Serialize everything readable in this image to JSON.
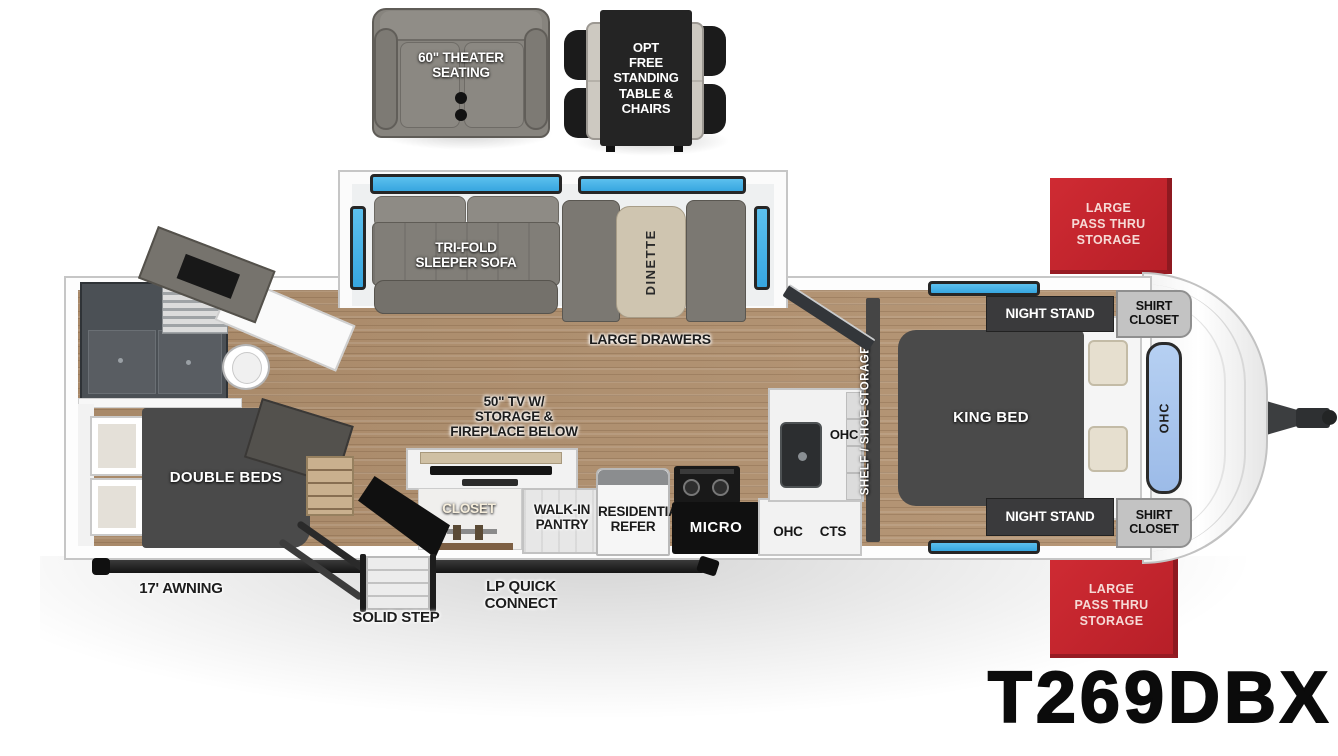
{
  "model_label": "T269DBX",
  "options": {
    "theater_seating": "60\" THEATER\nSEATING",
    "free_standing_table": "OPT\nFREE\nSTANDING\nTABLE &\nCHAIRS"
  },
  "living_area": {
    "sofa": "TRI-FOLD\nSLEEPER SOFA",
    "dinette": "DINETTE",
    "large_drawers": "LARGE DRAWERS",
    "tv_fireplace": "50\" TV W/\nSTORAGE &\nFIREPLACE BELOW",
    "closet": "CLOSET"
  },
  "kitchen": {
    "pantry": "WALK-IN\nPANTRY",
    "refer": "RESIDENTIAL\nREFER",
    "micro": "MICRO",
    "ohc_upper": "OHC",
    "ohc_lower": "OHC",
    "cts": "CTS"
  },
  "bedroom": {
    "king_bed": "KING BED",
    "night_stand_top": "NIGHT STAND",
    "night_stand_bottom": "NIGHT STAND",
    "shirt_closet_top": "SHIRT\nCLOSET",
    "shirt_closet_bottom": "SHIRT\nCLOSET",
    "shelf_shoe_storage": "SHELF / SHOE STORAGE",
    "ohc_front": "OHC"
  },
  "rear_bedroom": {
    "double_beds": "DOUBLE BEDS"
  },
  "exterior": {
    "pass_thru_top": "LARGE\nPASS THRU\nSTORAGE",
    "pass_thru_bottom": "LARGE\nPASS THRU\nSTORAGE",
    "awning": "17' AWNING",
    "solid_step": "SOLID STEP",
    "lp_quick_connect": "LP QUICK CONNECT"
  },
  "colors": {
    "accent_red": "#c4262e",
    "window_blue": "#45b1e8",
    "cap_window_blue": "#a9c6ee",
    "floor_wood": "#b2916f"
  }
}
